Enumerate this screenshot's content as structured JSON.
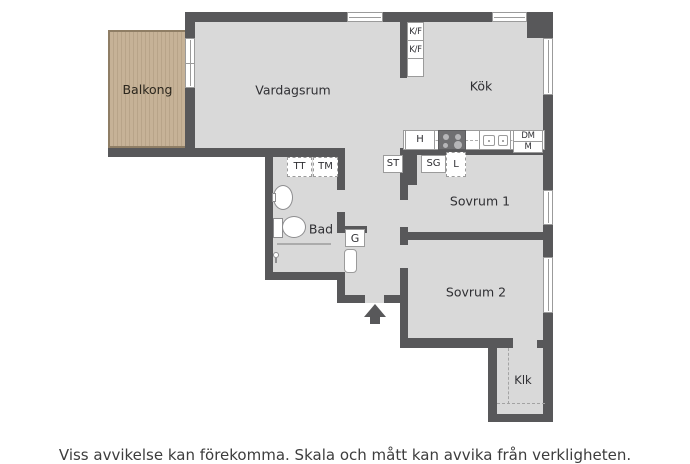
{
  "type": "apartment-floorplan",
  "rooms": {
    "balkong": "Balkong",
    "vardagsrum": "Vardagsrum",
    "kok": "Kök",
    "sovrum1": "Sovrum 1",
    "sovrum2": "Sovrum 2",
    "bad": "Bad",
    "klk": "Klk"
  },
  "fixtures": {
    "kf1": "K/F",
    "kf2": "K/F",
    "hob": "H",
    "dm": "DM",
    "m": "M",
    "st": "ST",
    "sg": "SG",
    "l": "L",
    "tt": "TT",
    "tm": "TM",
    "g": "G"
  },
  "caption": "Viss avvikelse kan förekomma. Skala och mått kan avvika från verkligheten.",
  "colors": {
    "wall": "#58585a",
    "floor": "#d9d9d9",
    "balcony_wood": "#c6b297",
    "balcony_stripe": "#b8a489",
    "balcony_edge": "#8f7e65",
    "fixture_line": "#9b9b9b",
    "text": "#2f2f33",
    "caption_text": "#3d3d3d",
    "background": "#ffffff"
  }
}
